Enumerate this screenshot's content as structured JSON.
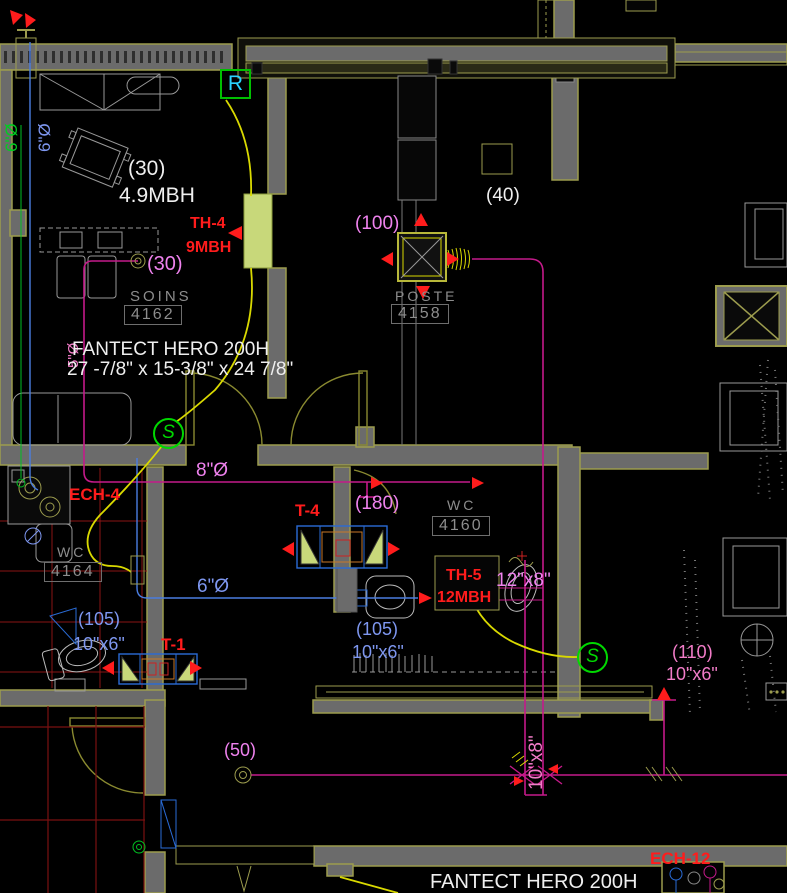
{
  "notes": {
    "fan_line1": "FANTECT HERO 200H",
    "fan_line2": "27 -7/8\" x 15-3/8\" x 24 7/8\"",
    "fan_bottom": "FANTECT HERO 200H",
    "baseboard_capacity": "4.9MBH"
  },
  "rooms": {
    "soins": {
      "name": "SOINS",
      "number": "4162"
    },
    "poste": {
      "name": "POSTE",
      "number": "4158"
    },
    "wc_4160": {
      "name": "WC",
      "number": "4160"
    },
    "wc_4164": {
      "name": "WC",
      "number": "4164"
    }
  },
  "equipment": {
    "th4": {
      "tag": "TH-4",
      "capacity": "9MBH"
    },
    "th5": {
      "tag": "TH-5",
      "capacity": "12MBH"
    },
    "t4": {
      "tag": "T-4"
    },
    "t1": {
      "tag": "T-1"
    },
    "ech4": {
      "tag": "ECH-4"
    },
    "ech12": {
      "tag": "ECH-12"
    },
    "return_marker": "R",
    "supply_marker": "S"
  },
  "airflows": {
    "soins_white": "(30)",
    "soins_branch": "(30)",
    "corridor": "(40)",
    "poste": "(100)",
    "wc4160": "(180)",
    "wc4164": "(105)",
    "counter": "(105)",
    "right": "(110)",
    "bottom": "(50)"
  },
  "duct_sizes": {
    "riser_green": "6\"Ø",
    "riser_blue": "6\"Ø",
    "branch_5": "5\"Ø",
    "corridor_8": "8\"Ø",
    "wc_6": "6\"Ø",
    "th5_12x8": "12\"x8\"",
    "wc4164_10x6": "10\"x6\"",
    "counter_10x6": "10\"x6\"",
    "right_10x6": "10\"x6\"",
    "vertical_10x8": "10\"x8\""
  },
  "colors": {
    "wall_fill": "#6b6b6b",
    "wall_edge": "#9c9c4e",
    "duct_magenta": "#c41a8a",
    "duct_blue": "#4a7de0",
    "flex_yellow": "#d9d900",
    "grid_red": "#7a1111",
    "marker_green": "#00d800"
  }
}
